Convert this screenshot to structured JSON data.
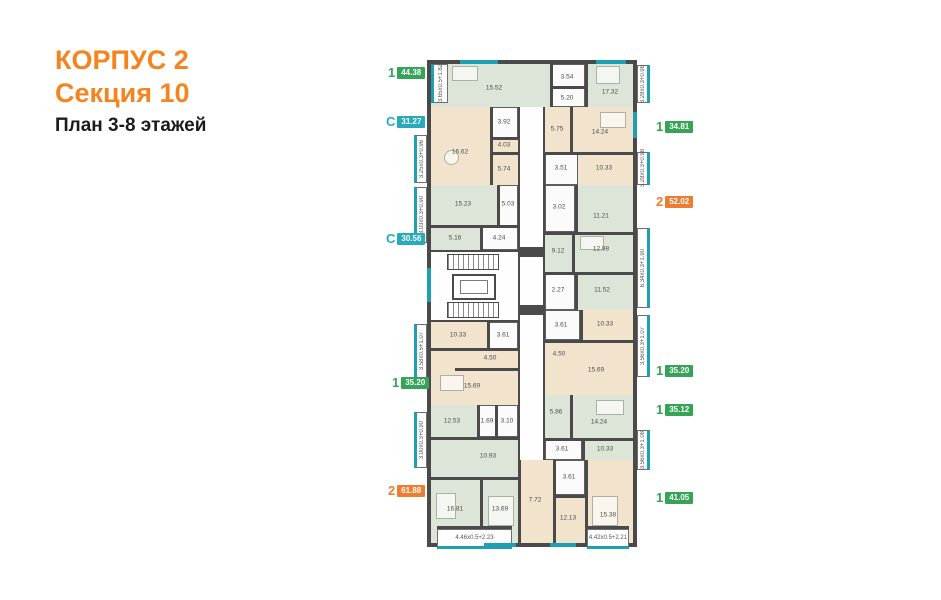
{
  "title": {
    "building": "КОРПУС 2",
    "section": "Секция 10",
    "plan": "План 3-8 этажей"
  },
  "colors": {
    "title_orange": "#F5841F",
    "badge_green": "#35A457",
    "badge_teal": "#27AABB",
    "badge_orange": "#ED7D31",
    "wall": "#4A4A4A",
    "room_green": "#DCE5D7",
    "room_beige": "#F2E3CD",
    "window_teal": "#1E9FB4"
  },
  "plan": {
    "apartments": [
      {
        "type": "1",
        "area": "44.38",
        "rooms": [
          "15.52",
          "3.54",
          "5.20",
          "17.32"
        ]
      },
      {
        "type": "С",
        "area": "31.27",
        "rooms": [
          "16.62",
          "3.92",
          "4.03",
          "5.74"
        ]
      },
      {
        "type": "С",
        "area": "30.56",
        "rooms": [
          "15.23",
          "5.03",
          "5.16",
          "4.24"
        ]
      },
      {
        "type": "1",
        "area": "35.20",
        "rooms": [
          "10.33",
          "3.61",
          "4.50",
          "15.69"
        ]
      },
      {
        "type": "2",
        "area": "61.88",
        "rooms": [
          "12.53",
          "1.69",
          "3.10",
          "10.93",
          "16.81",
          "13.69"
        ]
      },
      {
        "type": "1",
        "area": "34.81",
        "rooms": [
          "5.75",
          "14.24",
          "3.51",
          "10.33"
        ]
      },
      {
        "type": "2",
        "area": "52.02",
        "rooms": [
          "3.02",
          "11.21",
          "9.12",
          "12.98",
          "2.27",
          "11.52"
        ]
      },
      {
        "type": "1",
        "area": "35.20",
        "rooms": [
          "3.61",
          "10.33",
          "4.50",
          "15.69"
        ]
      },
      {
        "type": "1",
        "area": "35.12",
        "rooms": [
          "5.86",
          "14.24",
          "3.61",
          "10.33"
        ]
      },
      {
        "type": "1",
        "area": "41.05",
        "rooms": [
          "7.72",
          "3.61",
          "12.13",
          "15.38"
        ]
      }
    ],
    "balconies": [
      "3.65x0.5+1.82",
      "3.25x0.3+0.96",
      "3.03x0.3+0.90",
      "3.58x0.5+1.07",
      "3.00x0.3+0.90",
      "4.46x0.5+2.23",
      "3.28x0.3+0.98",
      "3.28x0.3+0.98",
      "6.34x0.3+1.90",
      "3.56x0.3+1.07",
      "3.56x0.3+1.08",
      "4.42x0.5+2.21"
    ]
  }
}
